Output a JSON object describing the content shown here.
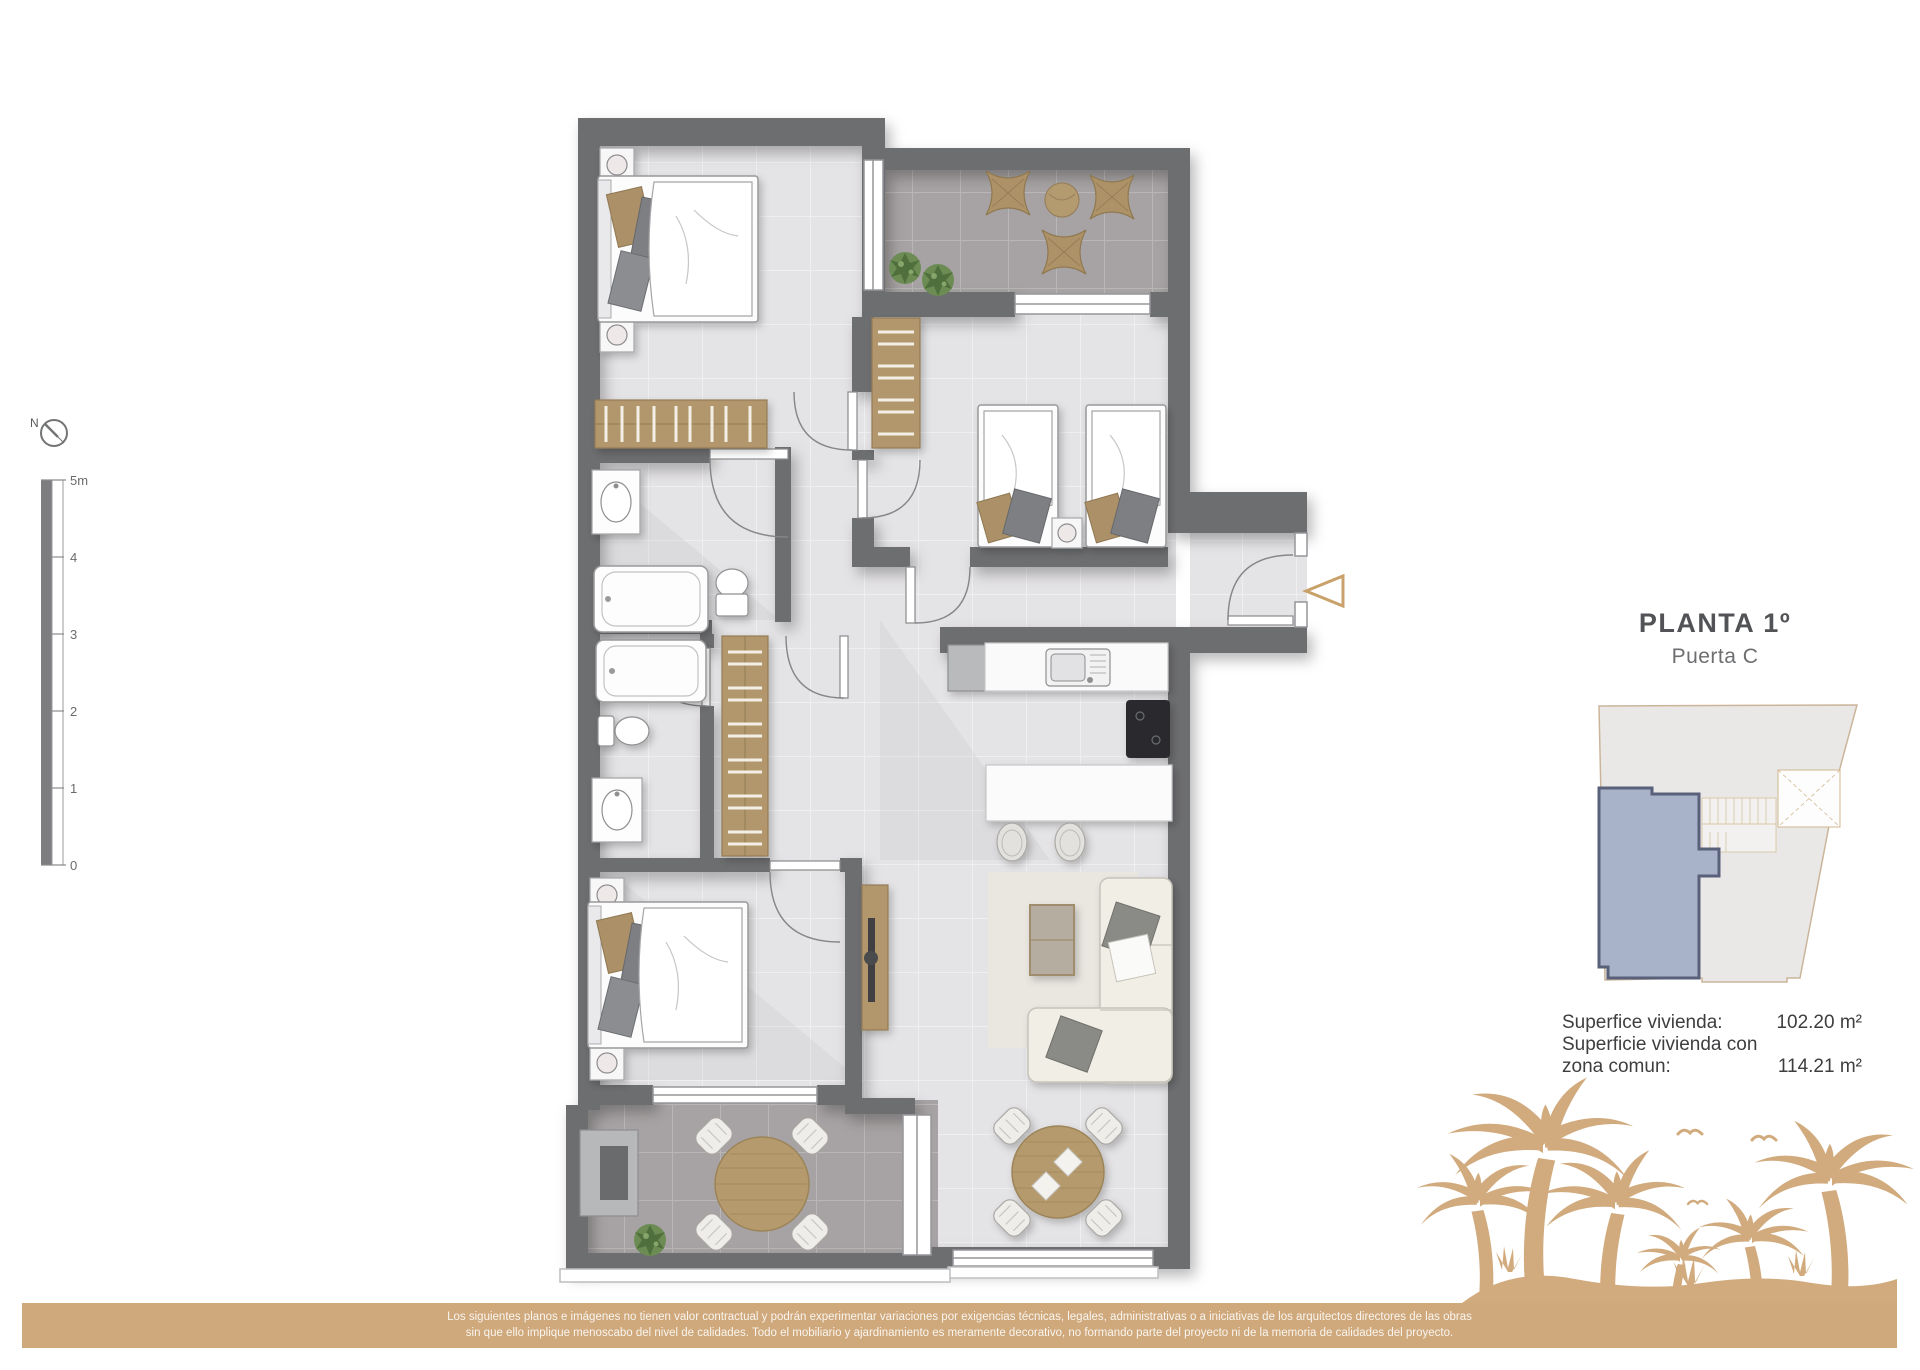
{
  "title_block": {
    "title": "PLANTA 1º",
    "subtitle": "Puerta C"
  },
  "areas": {
    "line1_label": "Superfice vivienda:",
    "line1_value": "102.20 m²",
    "line2_label": "Superficie vivienda con",
    "line3_label": "zona comun:",
    "line3_value": "114.21 m²"
  },
  "scale_bar": {
    "labels": [
      "5m",
      "4",
      "3",
      "2",
      "1",
      "0"
    ]
  },
  "compass": {
    "label": "N"
  },
  "footer": {
    "line1": "Los siguientes planos e imágenes no tienen valor contractual y podrán experimentar variaciones por exigencias técnicas, legales, administrativas o a iniciativas de los arquitectos directores de las obras",
    "line2": "sin que ello implique menoscabo del nivel de calidades. Todo el mobiliario y ajardinamiento es meramente decorativo, no formando parte del proyecto ni de la memoria de calidades del proyecto."
  },
  "colors": {
    "wall": "#6d6e70",
    "floor_light": "#e4e3e5",
    "floor_terrace": "#a7a3a4",
    "wood": "#b2976c",
    "accent_tan": "#cfa87c",
    "highlighted_unit": "#a8b2c8",
    "unit_outline": "#59607a"
  }
}
